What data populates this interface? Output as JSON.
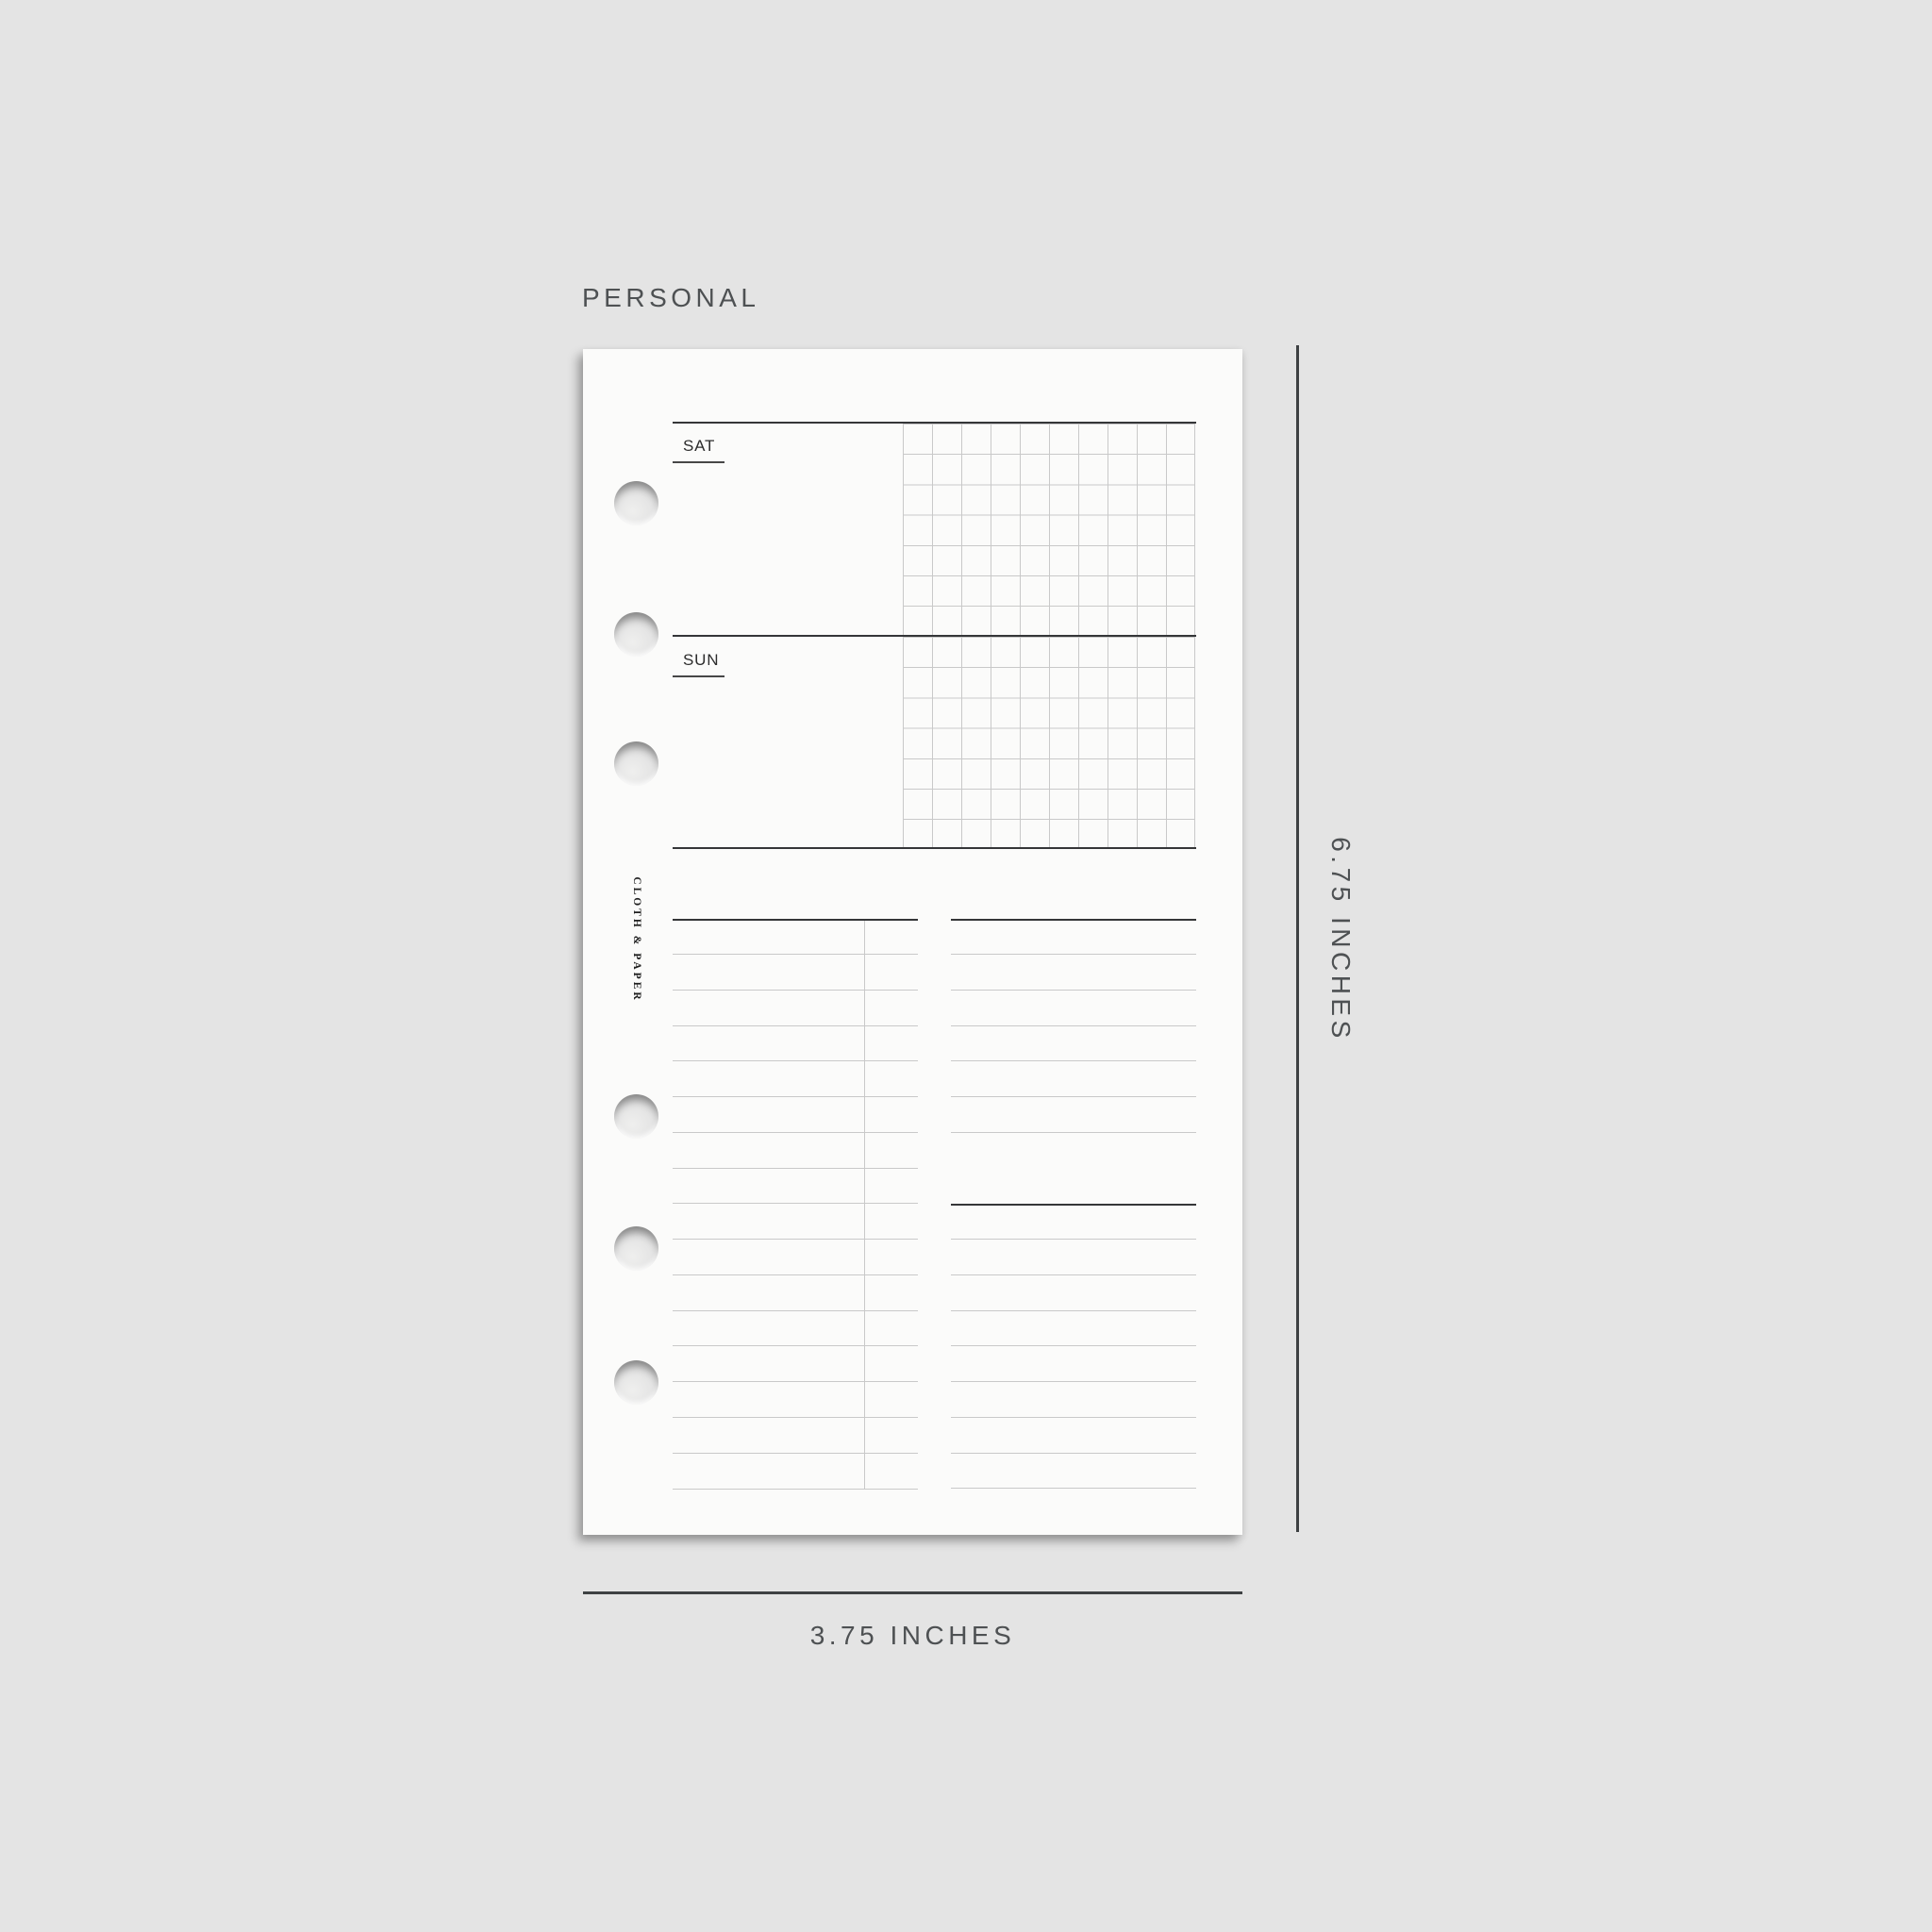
{
  "product_label": {
    "size_name": "PERSONAL"
  },
  "insert_page": {
    "brand": "CLOTH & PAPER",
    "weekend_section": {
      "saturday_label": "SAT",
      "sunday_label": "SUN",
      "grid_columns": 10,
      "grid_rows_per_day": 7
    },
    "punch_holes": {
      "count": 6,
      "centers_y": [
        163,
        302,
        439,
        813,
        953,
        1095
      ]
    },
    "lists": {
      "left_column_line_count": 16,
      "right_column_top_line_count": 6,
      "right_column_bottom_line_count": 8
    }
  },
  "dimension_annotations": {
    "height_label": "6.75 INCHES",
    "width_label": "3.75 INCHES"
  },
  "colors": {
    "bg": "#e4e4e4",
    "paper": "#fbfbfa",
    "rule_dark": "#353638",
    "rule_light": "#c9c9c9",
    "dim_line": "#3e4143",
    "dim_text": "#4e5153"
  }
}
